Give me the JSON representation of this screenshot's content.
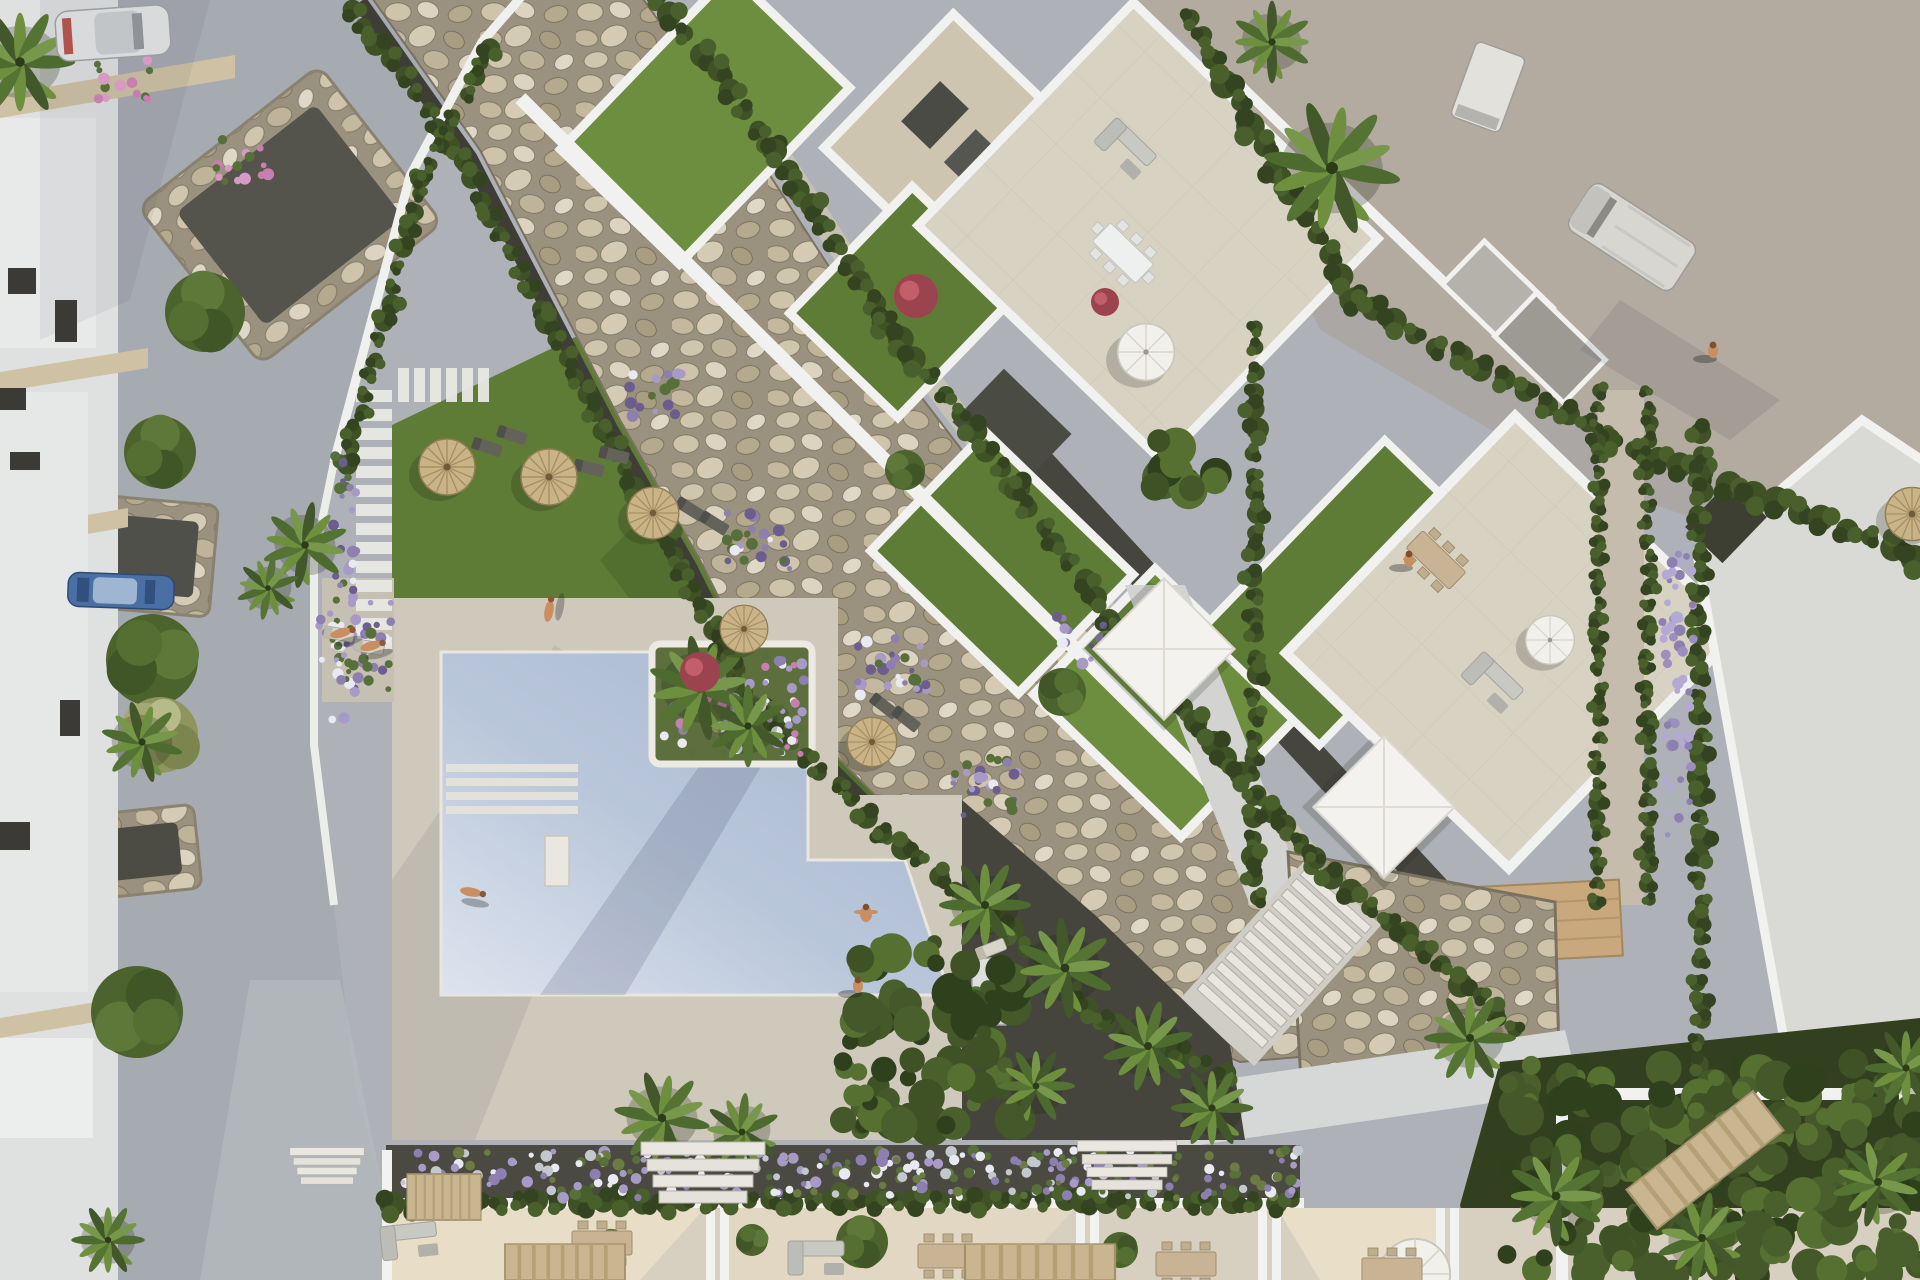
{
  "meta": {
    "description": "Aerial top-down 3D architectural rendering of a Mediterranean residential complex: communal swimming pool with white sun deck, lawn with straw parasols and loungers, diagonal decorative rock (riprap) strip flanked by hedges, white apartment blocks with rooftop garden terraces, townhouse patios along the bottom, access road with parked cars on the left and a sandy lot with vans at the top right.",
    "image_type": "photorealistic render, no visible text"
  },
  "palette": {
    "road": "#a6aab1",
    "roadLight": "#b7babf",
    "lawn": "#5e7c36",
    "lawnDark": "#4d682c",
    "lawnBright": "#6d8d3f",
    "water": "#aebdd6",
    "waterSun": "#dce3ee",
    "deck": "#cfc9bc",
    "paving": "#d8d2c3",
    "buildingWhite": "#f1f2f0",
    "rockBase": "#98907c",
    "tan": "#b3aaa0",
    "darkGravel": "#45453d",
    "hedge": "#3a4926",
    "pergola": "#c9b691",
    "wood": "#c8a87c",
    "straw": "#c9b488",
    "purple": "#8d7fb0",
    "lavender": "#9b8fc0",
    "pink": "#c77fae",
    "red": "#b7484d",
    "roofGray": "#d9d9d5"
  },
  "scene": {
    "walkway": {
      "x": 356,
      "w": 36,
      "y0": 390,
      "y1": 652,
      "step": 19,
      "bx0": 398,
      "bx1": 486,
      "by": 368,
      "bh": 34,
      "bstep": 16
    },
    "palms": [
      [
        20,
        62,
        1.2,
        0
      ],
      [
        142,
        742,
        0.9,
        15
      ],
      [
        305,
        545,
        0.95,
        40
      ],
      [
        268,
        588,
        0.7,
        -20
      ],
      [
        700,
        688,
        1.15,
        20
      ],
      [
        748,
        726,
        0.9,
        -30
      ],
      [
        1332,
        168,
        1.5,
        10
      ],
      [
        1272,
        42,
        0.9,
        30
      ],
      [
        985,
        905,
        1.0,
        0
      ],
      [
        1065,
        968,
        1.1,
        25
      ],
      [
        1148,
        1046,
        1.0,
        -15
      ],
      [
        1036,
        1086,
        0.85,
        60
      ],
      [
        1212,
        1108,
        0.9,
        0
      ],
      [
        662,
        1118,
        1.05,
        10
      ],
      [
        742,
        1132,
        0.85,
        -25
      ],
      [
        108,
        1240,
        0.8,
        0
      ],
      [
        1470,
        1038,
        1.0,
        0
      ],
      [
        1556,
        1196,
        1.1,
        30
      ],
      [
        1702,
        1238,
        1.0,
        -20
      ],
      [
        1906,
        1068,
        0.9,
        0
      ],
      [
        1878,
        1182,
        1.0,
        45
      ]
    ],
    "treesRound": [
      [
        152,
        660,
        46
      ],
      [
        205,
        312,
        40
      ],
      [
        160,
        452,
        36
      ],
      [
        137,
        1012,
        46
      ],
      [
        862,
        1242,
        26
      ],
      [
        752,
        1240,
        16
      ],
      [
        1120,
        1250,
        18
      ],
      [
        612,
        1242,
        13
      ],
      [
        1062,
        692,
        24
      ],
      [
        905,
        470,
        20
      ]
    ],
    "pampas": [
      [
        160,
        735,
        38
      ]
    ],
    "parasolsStraw": [
      [
        447,
        467,
        1
      ],
      [
        549,
        477,
        1
      ],
      [
        653,
        513,
        0.92
      ],
      [
        744,
        629,
        0.85
      ],
      [
        872,
        742,
        0.88
      ],
      [
        1912,
        514,
        0.95
      ]
    ],
    "parasolsWhite": [
      [
        1146,
        352,
        1.05
      ],
      [
        1550,
        640,
        0.9
      ],
      [
        1415,
        1274,
        1.3
      ]
    ],
    "sails": [
      [
        1164,
        649
      ],
      [
        1384,
        807
      ]
    ],
    "loungersDark": [
      [
        487,
        447,
        18
      ],
      [
        512,
        435,
        18
      ],
      [
        589,
        468,
        14
      ],
      [
        614,
        455,
        14
      ],
      [
        690,
        509,
        32
      ],
      [
        714,
        523,
        32
      ],
      [
        884,
        706,
        38
      ],
      [
        906,
        719,
        38
      ]
    ],
    "loungersWhite": [
      [
        339,
        634,
        10
      ],
      [
        369,
        647,
        10
      ],
      [
        991,
        949,
        -22
      ]
    ],
    "people": [
      [
        549,
        611,
        -80,
        "lying"
      ],
      [
        471,
        892,
        10,
        "lying"
      ],
      [
        866,
        914,
        0,
        "swim"
      ],
      [
        858,
        986,
        0,
        "stand"
      ],
      [
        1409,
        560,
        0,
        "stand"
      ],
      [
        1713,
        351,
        0,
        "stand"
      ],
      [
        341,
        633,
        -15,
        "lying"
      ],
      [
        371,
        646,
        -15,
        "lying"
      ]
    ],
    "vehicles": {
      "carWhite": [
        113,
        33,
        -4
      ],
      "carBlue": [
        121,
        591,
        2
      ],
      "van": [
        1632,
        237,
        33
      ],
      "truck": [
        1488,
        87,
        20
      ]
    },
    "tablesWhite": [
      [
        1123,
        253,
        44
      ]
    ],
    "tablesTan": [
      [
        1436,
        560,
        44
      ],
      [
        602,
        1243,
        0
      ],
      [
        948,
        1256,
        0
      ],
      [
        1186,
        1264,
        0
      ],
      [
        1392,
        1270,
        0
      ]
    ],
    "sofas": [
      [
        1126,
        148,
        44
      ],
      [
        409,
        1240,
        -6
      ],
      [
        816,
        1257,
        0
      ],
      [
        1493,
        682,
        44
      ]
    ],
    "pergolas": [
      [
        444,
        1197,
        74,
        46,
        0
      ],
      [
        565,
        1262,
        120,
        36,
        0
      ],
      [
        1040,
        1262,
        150,
        36,
        0
      ],
      [
        1705,
        1160,
        160,
        50,
        -38
      ]
    ],
    "steps": [
      [
        703,
        1176,
        1
      ],
      [
        1127,
        1168,
        0.8
      ],
      [
        327,
        1168,
        0.6
      ]
    ],
    "redShrubs": [
      [
        916,
        296,
        22
      ],
      [
        1105,
        302,
        14
      ],
      [
        700,
        672,
        20
      ]
    ],
    "hedges": [
      {
        "pts": [
          [
            354,
            7
          ],
          [
            464,
            162
          ],
          [
            604,
            432
          ],
          [
            684,
            572
          ],
          [
            744,
            692
          ],
          [
            884,
            832
          ],
          [
            994,
            917
          ],
          [
            1104,
            1022
          ],
          [
            1224,
            1074
          ]
        ],
        "r": 9,
        "sp": 20
      },
      {
        "pts": [
          [
            656,
            -5
          ],
          [
            776,
            150
          ],
          [
            886,
            320
          ],
          [
            1016,
            490
          ],
          [
            1166,
            690
          ],
          [
            1316,
            860
          ],
          [
            1514,
            1028
          ]
        ],
        "r": 10,
        "sp": 22
      },
      {
        "pts": [
          [
            422,
            178
          ],
          [
            346,
            466
          ]
        ],
        "r": 8,
        "sp": 18
      },
      {
        "pts": [
          [
            492,
            46
          ],
          [
            420,
            181
          ]
        ],
        "r": 8,
        "sp": 18
      },
      {
        "pts": [
          [
            1190,
            16
          ],
          [
            1352,
            300
          ],
          [
            1610,
            438
          ],
          [
            1916,
            556
          ]
        ],
        "r": 11,
        "sp": 24
      },
      {
        "pts": [
          [
            1255,
            330
          ],
          [
            1255,
            900
          ]
        ],
        "r": 9,
        "sp": 20
      },
      {
        "pts": [
          [
            1598,
            392
          ],
          [
            1598,
            900
          ]
        ],
        "r": 7,
        "sp": 16
      },
      {
        "pts": [
          [
            1648,
            392
          ],
          [
            1648,
            900
          ]
        ],
        "r": 7,
        "sp": 16
      },
      {
        "pts": [
          [
            1700,
            432
          ],
          [
            1700,
            1062
          ]
        ],
        "r": 9,
        "sp": 20
      },
      {
        "pts": [
          [
            392,
            1202
          ],
          [
            1295,
            1202
          ]
        ],
        "r": 10,
        "sp": 21
      }
    ],
    "flowerBeds": [
      {
        "rect": [
          332,
          455,
          26,
          265
        ],
        "kind": "purpleMix"
      },
      {
        "rect": [
          318,
          600,
          76,
          100
        ],
        "kind": "purpleMix"
      },
      {
        "rect": [
          398,
          1150,
          900,
          48
        ],
        "kind": "bedMix"
      },
      {
        "rect": [
          662,
          654,
          142,
          100
        ],
        "kind": "purplePink"
      },
      {
        "rect": [
          1662,
          550,
          32,
          285
        ],
        "kind": "lavender"
      },
      {
        "rect": [
          726,
          512,
          64,
          58
        ],
        "kind": "purpleMix"
      },
      {
        "rect": [
          856,
          636,
          72,
          60
        ],
        "kind": "purpleMix"
      },
      {
        "rect": [
          952,
          756,
          72,
          62
        ],
        "kind": "purpleMix"
      },
      {
        "rect": [
          628,
          372,
          54,
          50
        ],
        "kind": "purpleMix"
      },
      {
        "rect": [
          1056,
          614,
          60,
          52
        ],
        "kind": "purpleMix"
      },
      {
        "rect": [
          214,
          138,
          58,
          44
        ],
        "kind": "pinkMix"
      },
      {
        "rect": [
          96,
          60,
          56,
          40
        ],
        "kind": "pinkMix"
      },
      {
        "rect": [
          1500,
          1062,
          420,
          215
        ],
        "kind": "shrubs"
      },
      {
        "rect": [
          1130,
          440,
          90,
          60
        ],
        "kind": "shrubs"
      },
      {
        "rect": [
          840,
          940,
          180,
          190
        ],
        "kind": "shrubs"
      }
    ]
  }
}
